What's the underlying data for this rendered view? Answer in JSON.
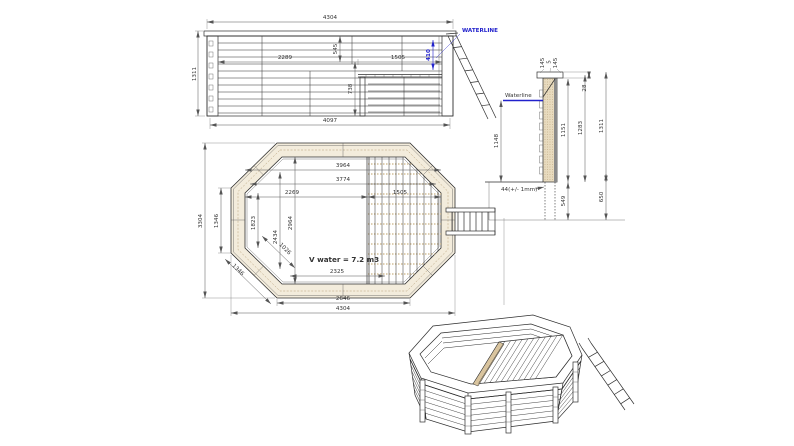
{
  "colors": {
    "accent_blue": "#2121cc",
    "line": "#2e2e2e",
    "wood_light": "#f3ecdc",
    "wood_dark": "#d9c49e"
  },
  "elevation": {
    "waterline": "WATERLINE",
    "dims": {
      "overall_top": "4304",
      "height": "1311",
      "water_zone": "2289",
      "rim_drop": "545",
      "deck_zone": "1505",
      "water_depth": "410",
      "under_deck": "738",
      "overall_bottom": "4097"
    }
  },
  "section": {
    "waterline": "Waterline",
    "dims": {
      "cap_outer": "145",
      "cap_gap": "5",
      "cap_inner": "145",
      "overhang": "28",
      "water_height": "1148",
      "inner_height": "1151",
      "wall_height": "1283",
      "total_height": "1311",
      "embed_depth": "549",
      "embed_total": "650",
      "thickness": "44(+/- 1mm)"
    }
  },
  "plan": {
    "volume": "V water = 7.2 m3",
    "dims": {
      "inner_top": "3964",
      "inner_mid": "3774",
      "water_width": "2269",
      "deck_width": "1505",
      "inner_height": "2964",
      "mid_height": "2434",
      "side_inner": "1823",
      "diag_inner": "1026",
      "outer_height": "3304",
      "side_outer": "1346",
      "diag_outer": "1346",
      "water_bottom": "2325",
      "bottom_edge": "2646",
      "overall_width": "4304"
    }
  }
}
